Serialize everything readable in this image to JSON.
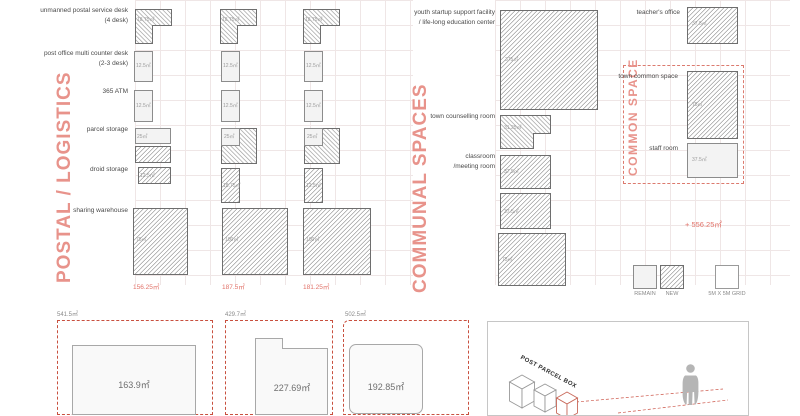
{
  "colors": {
    "accent_salmon": "#e8938b",
    "total_red": "#e2736a",
    "dash_red": "#c8503f"
  },
  "postal": {
    "title": "POSTAL / LOGISTICS",
    "rows": [
      {
        "l1": "unmanned postal service desk",
        "l2": "(4 desk)"
      },
      {
        "l1": "post office multi counter desk",
        "l2": "(2-3 desk)"
      },
      {
        "l1": "365 ATM",
        "l2": ""
      },
      {
        "l1": "parcel storage",
        "l2": ""
      },
      {
        "l1": "droid storage",
        "l2": ""
      },
      {
        "l1": "sharing warehouse",
        "l2": ""
      }
    ],
    "columns": [
      {
        "header": "SMALL 2 DONG",
        "unmanned": "18.75㎡",
        "counter": "12.5㎡",
        "atm": "12.5㎡",
        "parcel": "25㎡",
        "droid": "12.5㎡",
        "warehouse": "75㎡",
        "total": "156.25㎡"
      },
      {
        "header": "MEDIUM 3 DONG",
        "unmanned": "18.75㎡",
        "counter": "12.5㎡",
        "atm": "12.5㎡",
        "parcel": "25㎡",
        "droid": "18.75㎡",
        "warehouse": "100㎡",
        "total": "187.5㎡"
      },
      {
        "header": "LARGE 4 DONG",
        "unmanned": "18.75㎡",
        "counter": "12.5㎡",
        "atm": "12.5㎡",
        "parcel": "25㎡",
        "droid": "12.5㎡",
        "warehouse": "100㎡",
        "total": "181.25㎡"
      }
    ]
  },
  "communal": {
    "title": "COMMUNAL SPACES",
    "youth_l1": "youth startup support facility",
    "youth_l2": "/ life-long education center",
    "youth_area": "375㎡",
    "counselling_label": "town counselling room",
    "counselling_area": "31.25㎡",
    "classroom_l1": "classroom",
    "classroom_l2": "/meeting room",
    "classroom_area_1": "37.5㎡",
    "classroom_area_2": "37.5㎡",
    "classroom_area_3": "75㎡",
    "total": "+ 556.25㎡"
  },
  "common": {
    "title": "COMMON SPACE",
    "teacher_label": "teacher's office",
    "teacher_area": "37.5㎡",
    "town_label": "town common space",
    "town_area": "75㎡",
    "staff_label": "staff room",
    "staff_area": "37.5㎡"
  },
  "legend": {
    "remain": "REMAIN",
    "new": "NEW",
    "grid": "5M X 5M GRID"
  },
  "plans": [
    {
      "total": "541.5㎡",
      "area": "163.9㎡"
    },
    {
      "total": "429.7㎡",
      "area": "227.69㎡"
    },
    {
      "total": "502.5㎡",
      "area": "192.85㎡"
    }
  ],
  "parcel_panel": {
    "label": "POST PARCEL BOX"
  }
}
